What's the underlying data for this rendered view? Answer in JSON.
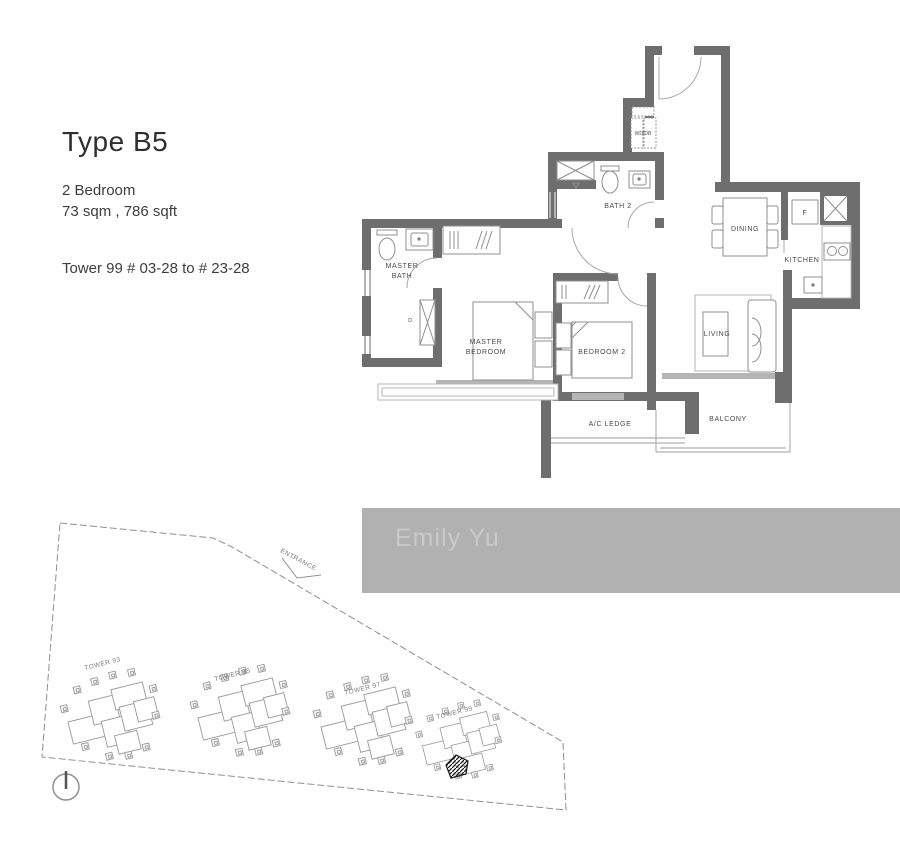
{
  "header": {
    "title": "Type B5",
    "bedroom_info": "2 Bedroom",
    "area_info": "73 sqm , 786 sqft",
    "tower_range": "Tower 99 # 03-28 to # 23-28"
  },
  "floorplan": {
    "labels": {
      "wd_db": "WD/DB",
      "bath2": "BATH 2",
      "master_bath_line1": "MASTER",
      "master_bath_line2": "BATH",
      "utility_door": "D",
      "master_bedroom_line1": "MASTER",
      "master_bedroom_line2": "BEDROOM",
      "bedroom2": "BEDROOM 2",
      "living": "LIVING",
      "dining": "DINING",
      "kitchen": "KITCHEN",
      "fridge": "F",
      "ac_ledge": "A/C LEDGE",
      "balcony": "BALCONY"
    }
  },
  "siteplan": {
    "entrance_label": "ENTRANCE",
    "towers": [
      {
        "label": "TOWER 93",
        "highlighted": false
      },
      {
        "label": "TOWER 95",
        "highlighted": false
      },
      {
        "label": "TOWER 97",
        "highlighted": false
      },
      {
        "label": "TOWER 99",
        "highlighted": true
      }
    ],
    "compass": "north-up"
  },
  "watermark": {
    "text": "Emily Yu"
  },
  "colors": {
    "wall": "#6e6e6e",
    "light_wall": "#b4b4b4",
    "fixture_line": "#8f8f8f",
    "label_text": "#4a4a4a",
    "site_line": "#8f8f8f",
    "watermark_bar": "#b1b1b1",
    "watermark_text": "#c9c9c9",
    "unit_highlight": "#1a1a1a"
  }
}
